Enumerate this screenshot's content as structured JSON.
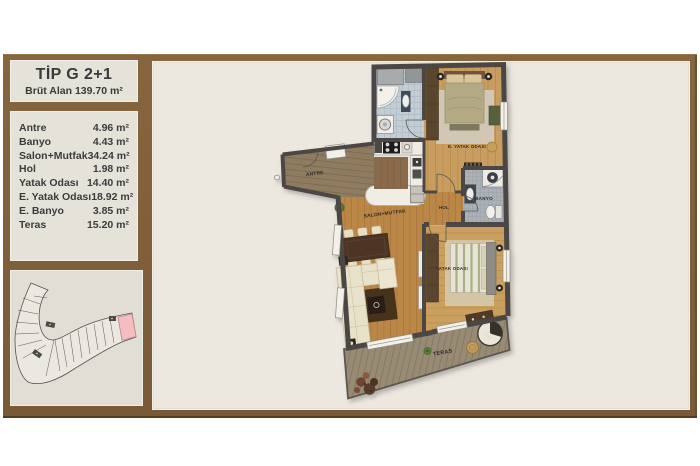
{
  "panel": {
    "title": "TİP G 2+1",
    "subtitle": "Brüt Alan  139.70 m²",
    "rooms": [
      {
        "label": "Antre",
        "area": "4.96 m²"
      },
      {
        "label": "Banyo",
        "area": "4.43 m²"
      },
      {
        "label": "Salon+Mutfak",
        "area": "34.24 m²"
      },
      {
        "label": "Hol",
        "area": "1.98 m²"
      },
      {
        "label": "Yatak Odası",
        "area": "14.40 m²"
      },
      {
        "label": "E. Yatak Odası",
        "area": "18.92 m²"
      },
      {
        "label": "E. Banyo",
        "area": "3.85 m²"
      },
      {
        "label": "Teras",
        "area": "15.20 m²"
      }
    ]
  },
  "plan": {
    "labels": {
      "antre": "ANTRE",
      "salon": "SALON+MUTFAK",
      "hol": "HOL",
      "banyo": "BANYO",
      "e_yatak": "E. YATAK ODASI",
      "yatak": "YATAK ODASI",
      "teras": "TERAS"
    }
  },
  "colors": {
    "frame_brown": "#7d5f3d",
    "panel_bg": "#e5e2da",
    "canvas_bg": "#ece8e0",
    "wall_gray": "#4b4744",
    "wood_salon": "#bb8747",
    "wood_bedroom": "#c99d5e",
    "wood_antre": "#8f7c60",
    "tile_bath": "#c2cdd4",
    "tile_banyo": "#abb1b6",
    "deck": "#978b74",
    "highlight_pink": "#f4bdc2",
    "text_dark": "#3c3c3c"
  }
}
